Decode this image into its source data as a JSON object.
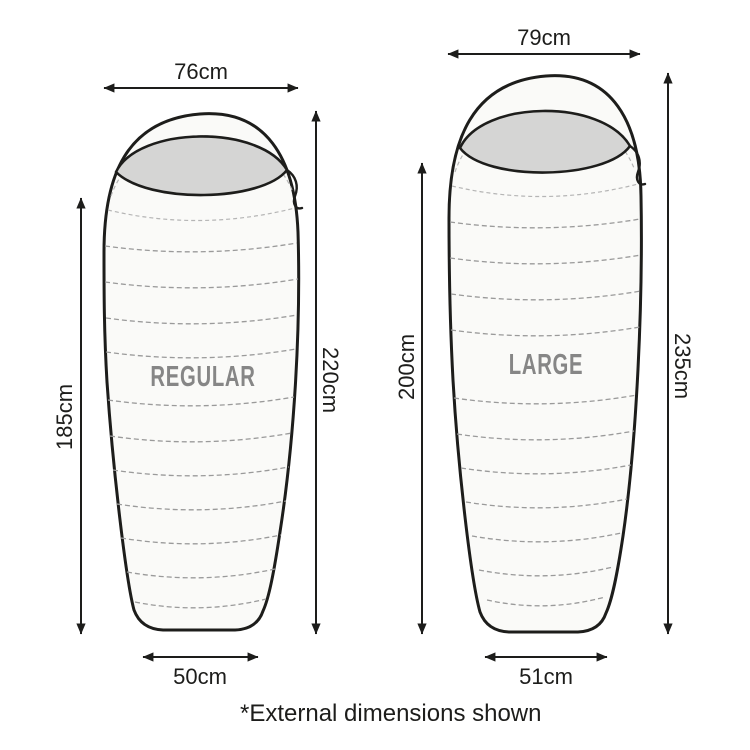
{
  "footnote": "*External dimensions shown",
  "colors": {
    "outline": "#1d1d1b",
    "ink": "#1d1d1b",
    "bag_fill": "#fafaf8",
    "hood_fill": "#d5d5d4",
    "dash": "#9a9a9a",
    "seam": "#b5b5b5",
    "label_gray": "#868686"
  },
  "bags": [
    {
      "name": "REGULAR",
      "top_width": "76cm",
      "inner_length": "185cm",
      "outer_length": "220cm",
      "foot_width": "50cm"
    },
    {
      "name": "LARGE",
      "top_width": "79cm",
      "inner_length": "200cm",
      "outer_length": "235cm",
      "foot_width": "51cm"
    }
  ]
}
